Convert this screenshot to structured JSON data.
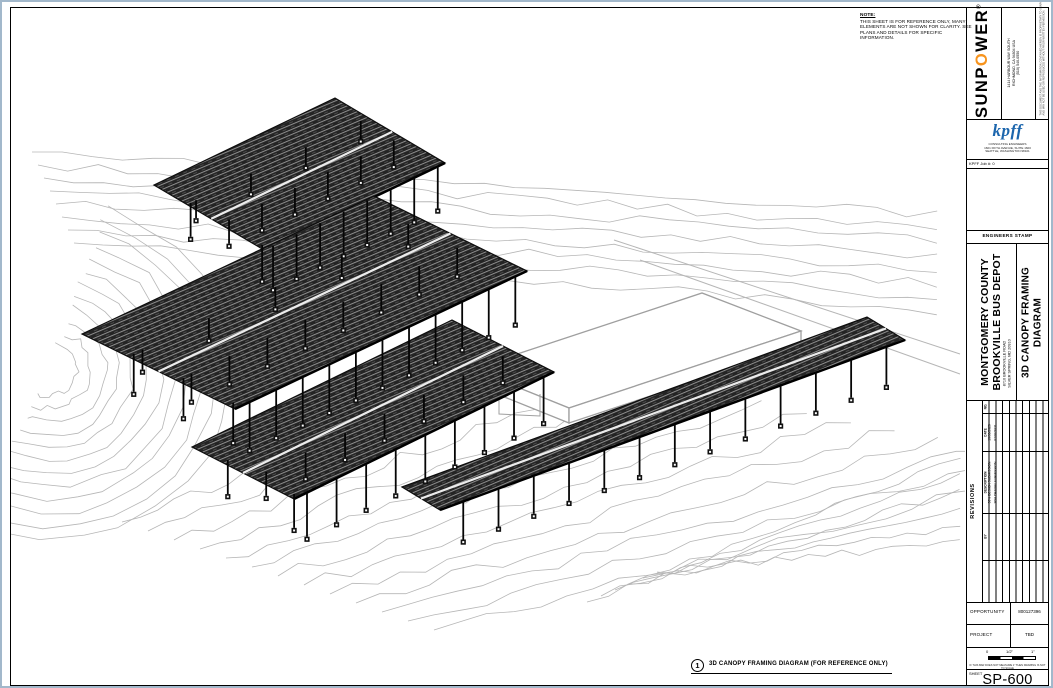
{
  "page": {
    "note": {
      "heading": "NOTE:",
      "lines": [
        "THIS SHEET IS FOR REFERENCE ONLY, MANY",
        "ELEMENTS ARE NOT SHOWN FOR CLARITY. SEE",
        "PLANS AND DETAILS FOR SPECIFIC INFORMATION."
      ]
    },
    "viewport_label": {
      "number": "1",
      "title": "3D CANOPY FRAMING DIAGRAM (FOR REFERENCE ONLY)"
    }
  },
  "titleblock": {
    "sunpower": {
      "brand_pre": "SUNP",
      "brand_o": "O",
      "brand_post": "WER",
      "reg": "®",
      "address_lines": [
        "1414 HARBOUR WAY SOUTH",
        "RICHMOND, CA 94804 USA",
        "(510) 540-0550"
      ],
      "legal_lines": [
        "THIS DOCUMENT AND THE INFORMATION CONTAINED HEREIN IS PROPRIETARY TO SUNPOWER CORP.",
        "AND MAY NOT BE USED OR REPRODUCED WITHOUT PRIOR WRITTEN PERMISSION."
      ]
    },
    "kpff": {
      "logo": "kpff",
      "sub_lines": [
        "CONSULTING ENGINEERS",
        "1601 FIFTH AVENUE, SUITE 1600",
        "SEATTLE, WASHINGTON 98101"
      ],
      "job": "KPFF Job #: 0"
    },
    "stamp_label": "ENGINEERS STAMP",
    "project": {
      "client_line1": "MONTGOMERY COUNTY",
      "client_line2": "BROOKVILLE BUS DEPOT",
      "address_line1": "8710 BROOKVILLE ROAD",
      "address_line2": "SILVER SPRING, MD 20910",
      "title_line1": "3D CANOPY FRAMING",
      "title_line2": "DIAGRAM"
    },
    "revisions": {
      "label": "REVISIONS",
      "headers": {
        "no": "NO.",
        "date": "DATE",
        "description": "DESCRIPTION",
        "by": "BY"
      },
      "entries": [
        {
          "date": "10/30/2020",
          "description": "30% DESIGN SUBMISSION"
        },
        {
          "date": "07/02/2021",
          "description": "90% DESIGN SUBMISSION"
        }
      ]
    },
    "opportunity": {
      "label": "OPPORTUNITY",
      "value": "800127396"
    },
    "project_row": {
      "label": "PROJECT",
      "value": "TBD"
    },
    "scale_bar": {
      "tick0": "0",
      "tick_half": "1/2\"",
      "tick_one": "1\"",
      "note": "IF THIS BAR DOES NOT MEASURE 1\" THEN DRAWING IS NOT TO SCALE"
    },
    "sheet": {
      "label": "SHEET",
      "number": "SP-600"
    }
  },
  "drawing": {
    "colors": {
      "contour": "#b6b6b6",
      "canopy_fill": "#242424",
      "canopy_stripe": "#8f8f8f",
      "outline": "#0d0d0d",
      "building_stroke": "#9f9f9f",
      "gap": "#ececec"
    },
    "canopies": [
      {
        "c0": [
          152,
          183
        ],
        "c1": [
          333,
          96
        ],
        "c3": [
          262,
          248
        ],
        "gap_b": 0.52,
        "rows": [
          {
            "b": 1,
            "n": 8,
            "len": 42
          },
          {
            "b": 0.6,
            "n": 6,
            "len": 24
          },
          {
            "b": 0.3,
            "n": 4,
            "len": 18
          }
        ],
        "left_posts": {
          "n": 2,
          "len": 34
        }
      },
      {
        "c0": [
          80,
          332
        ],
        "c1": [
          372,
          194
        ],
        "c3": [
          233,
          407
        ],
        "gap_b": 0.5,
        "rows": [
          {
            "b": 1,
            "n": 11,
            "len": 46
          },
          {
            "b": 0.62,
            "n": 8,
            "len": 26
          },
          {
            "b": 0.3,
            "n": 5,
            "len": 20
          }
        ],
        "left_posts": {
          "n": 3,
          "len": 38
        }
      },
      {
        "c0": [
          190,
          445
        ],
        "c1": [
          450,
          318
        ],
        "c3": [
          292,
          497
        ],
        "gap_b": 0.5,
        "rows": [
          {
            "b": 1,
            "n": 9,
            "len": 44
          },
          {
            "b": 0.6,
            "n": 7,
            "len": 24
          }
        ],
        "left_posts": {
          "n": 2,
          "len": 34
        }
      },
      {
        "c0": [
          400,
          485
        ],
        "c1": [
          865,
          315
        ],
        "c3": [
          438,
          508
        ],
        "gap_b": 0.5,
        "rows": [
          {
            "b": 1,
            "n": 13,
            "len": 38
          }
        ]
      }
    ],
    "building": {
      "top": [
        [
          470,
          367
        ],
        [
          700,
          291
        ],
        [
          799,
          329
        ],
        [
          567,
          406
        ]
      ],
      "face_left": [
        [
          470,
          367
        ],
        [
          470,
          382
        ],
        [
          567,
          421
        ],
        [
          567,
          406
        ]
      ],
      "face_right": [
        [
          567,
          406
        ],
        [
          567,
          421
        ],
        [
          799,
          344
        ],
        [
          799,
          329
        ]
      ],
      "step": [
        [
          497,
          380
        ],
        [
          497,
          412
        ],
        [
          538,
          414
        ],
        [
          538,
          392
        ]
      ]
    }
  }
}
